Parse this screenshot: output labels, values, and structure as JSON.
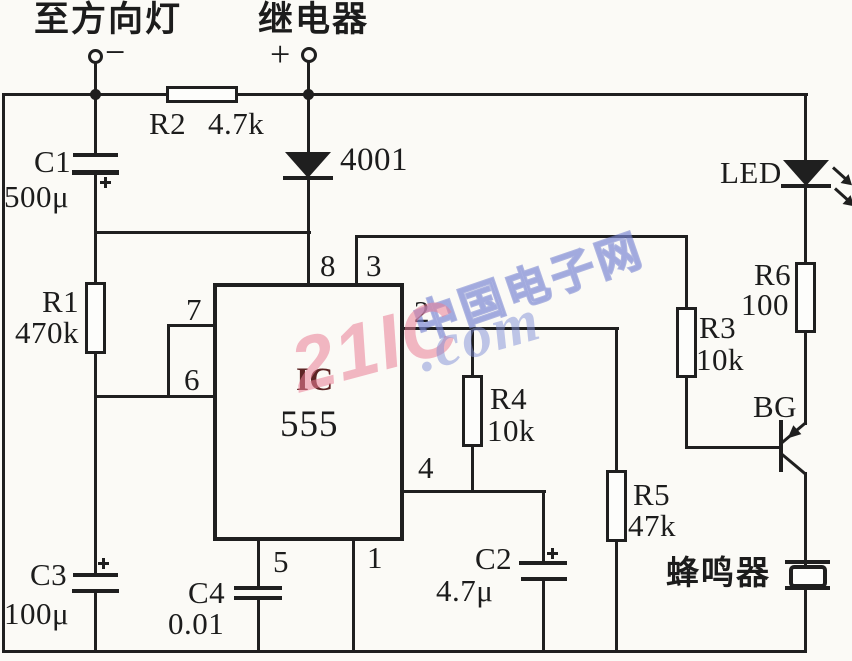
{
  "header": {
    "direction_light_label": "至方向灯",
    "direction_light_polarity": "−",
    "relay_label": "继电器",
    "relay_polarity": "+"
  },
  "components": {
    "r1": {
      "ref": "R1",
      "value": "470k"
    },
    "r2": {
      "ref": "R2",
      "value": "4.7k"
    },
    "r3": {
      "ref": "R3",
      "value": "10k"
    },
    "r4": {
      "ref": "R4",
      "value": "10k"
    },
    "r5": {
      "ref": "R5",
      "value": "47k"
    },
    "r6": {
      "ref": "R6",
      "value": "100"
    },
    "c1": {
      "ref": "C1",
      "value": "500μ"
    },
    "c2": {
      "ref": "C2",
      "value": "4.7μ"
    },
    "c3": {
      "ref": "C3",
      "value": "100μ"
    },
    "c4": {
      "ref": "C4",
      "value": "0.01"
    },
    "diode": {
      "ref": "4001"
    },
    "led": {
      "ref": "LED"
    },
    "transistor": {
      "ref": "BG"
    },
    "buzzer": {
      "ref": "蜂鸣器"
    },
    "ic": {
      "ref": "IC",
      "value": "555"
    }
  },
  "pins": {
    "p1": "1",
    "p2": "2",
    "p3": "3",
    "p4": "4",
    "p5": "5",
    "p6": "6",
    "p7": "7",
    "p8": "8"
  },
  "watermark": {
    "site_name": "中国电子网",
    "brand": "21IC",
    "domain": ".com"
  }
}
